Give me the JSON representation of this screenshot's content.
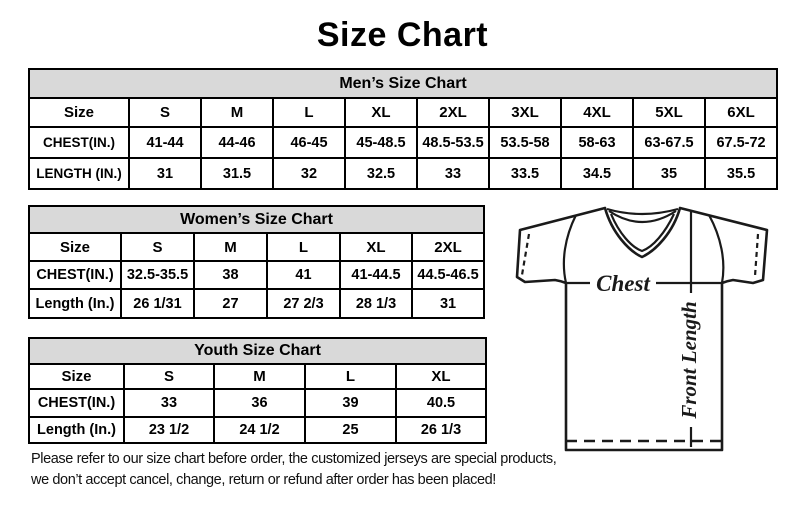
{
  "page": {
    "title": "Size Chart"
  },
  "tables": {
    "mens": {
      "title": "Men’s Size Chart",
      "rows": [
        [
          "Size",
          "S",
          "M",
          "L",
          "XL",
          "2XL",
          "3XL",
          "4XL",
          "5XL",
          "6XL"
        ],
        [
          "CHEST(IN.)",
          "41-44",
          "44-46",
          "46-45",
          "45-48.5",
          "48.5-53.5",
          "53.5-58",
          "58-63",
          "63-67.5",
          "67.5-72"
        ],
        [
          "LENGTH (IN.)",
          "31",
          "31.5",
          "32",
          "32.5",
          "33",
          "33.5",
          "34.5",
          "35",
          "35.5"
        ]
      ]
    },
    "womens": {
      "title": "Women’s Size Chart",
      "rows": [
        [
          "Size",
          "S",
          "M",
          "L",
          "XL",
          "2XL"
        ],
        [
          "CHEST(IN.)",
          "32.5-35.5",
          "38",
          "41",
          "41-44.5",
          "44.5-46.5"
        ],
        [
          "Length (In.)",
          "26 1/31",
          "27",
          "27 2/3",
          "28 1/3",
          "31"
        ]
      ]
    },
    "youth": {
      "title": "Youth Size Chart",
      "rows": [
        [
          "Size",
          "S",
          "M",
          "L",
          "XL"
        ],
        [
          "CHEST(IN.)",
          "33",
          "36",
          "39",
          "40.5"
        ],
        [
          "Length (In.)",
          "23 1/2",
          "24 1/2",
          "25",
          "26 1/3"
        ]
      ]
    }
  },
  "disclaimer": {
    "line1": "Please refer to our size chart before order, the customized jerseys are special products,",
    "line2": "we don’t accept cancel, change, return or refund after order has been placed!"
  },
  "diagram": {
    "chest_label": "Chest",
    "front_length_label": "Front Length"
  },
  "colors": {
    "header_bg": "#d9d9d9",
    "border": "#000000",
    "text": "#000000",
    "background": "#ffffff"
  }
}
